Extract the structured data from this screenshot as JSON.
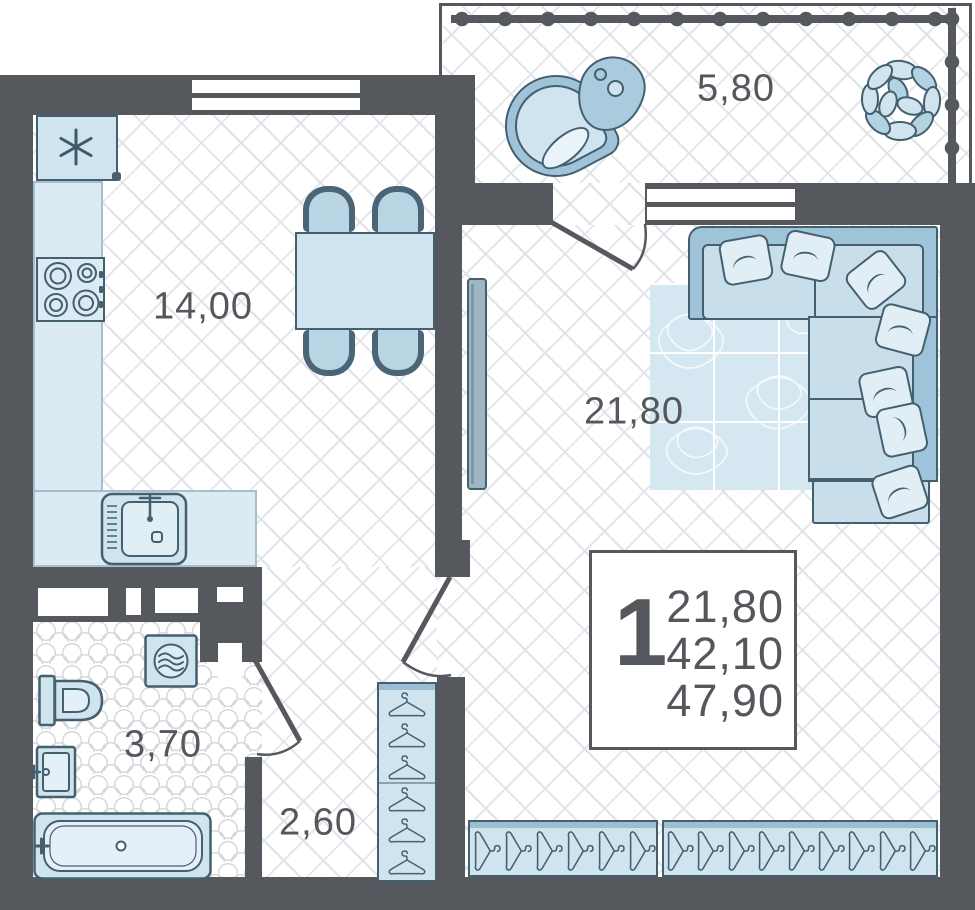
{
  "plan_title": "1-room apartment floor plan",
  "info_box": {
    "rooms_count": "1",
    "values": [
      "21,80",
      "42,10",
      "47,90"
    ]
  },
  "rooms": {
    "kitchen": {
      "label": "14,00"
    },
    "living": {
      "label": "21,80"
    },
    "balcony": {
      "label": "5,80"
    },
    "bathroom": {
      "label": "3,70"
    },
    "hallway": {
      "label": "2,60"
    }
  },
  "furniture": {
    "kitchen": [
      "fridge",
      "counter",
      "stove",
      "sink",
      "dining-table",
      "chairs"
    ],
    "living": [
      "tv",
      "rug",
      "corner-sofa",
      "pillows",
      "ottoman",
      "wardrobes"
    ],
    "balcony": [
      "hanging-chair",
      "side-table",
      "plant"
    ],
    "bathroom": [
      "washing-machine",
      "toilet",
      "sink",
      "bathtub"
    ],
    "hallway": [
      "wardrobe-with-hangers"
    ]
  },
  "colors": {
    "wall": "#55595e",
    "furniture_outline": "#44606f",
    "furniture_light": "#cfe4ef",
    "furniture_medium": "#a3c6da",
    "text": "#54585c",
    "floor_line": "#dfe3e8"
  }
}
